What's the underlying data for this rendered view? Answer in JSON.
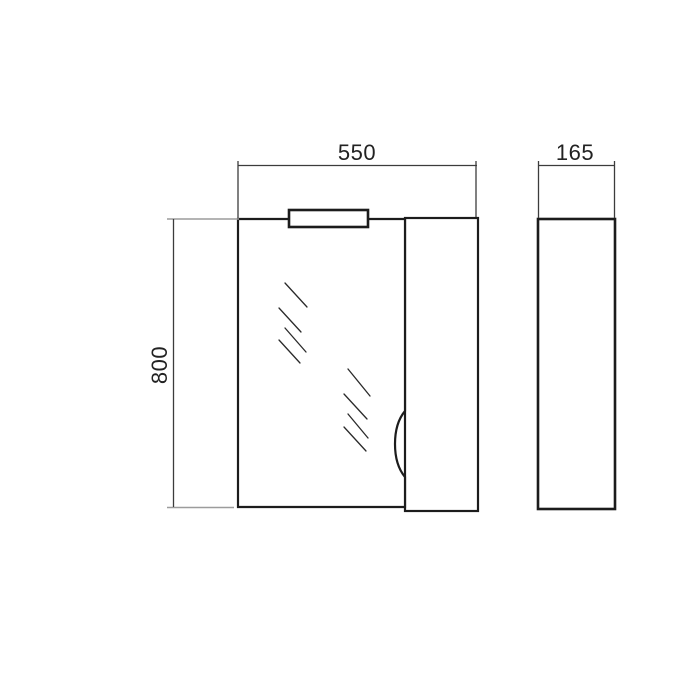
{
  "drawing": {
    "dimensions": {
      "width": "550",
      "depth": "165",
      "height": "800"
    }
  },
  "colors": {
    "paper": "#ffffff",
    "outline": "#1c1c1c",
    "dimension_line": "#3c3c3c",
    "extension_line": "#9c9c9c",
    "hatch_line": "#2a2a2a",
    "text": "#222222"
  }
}
